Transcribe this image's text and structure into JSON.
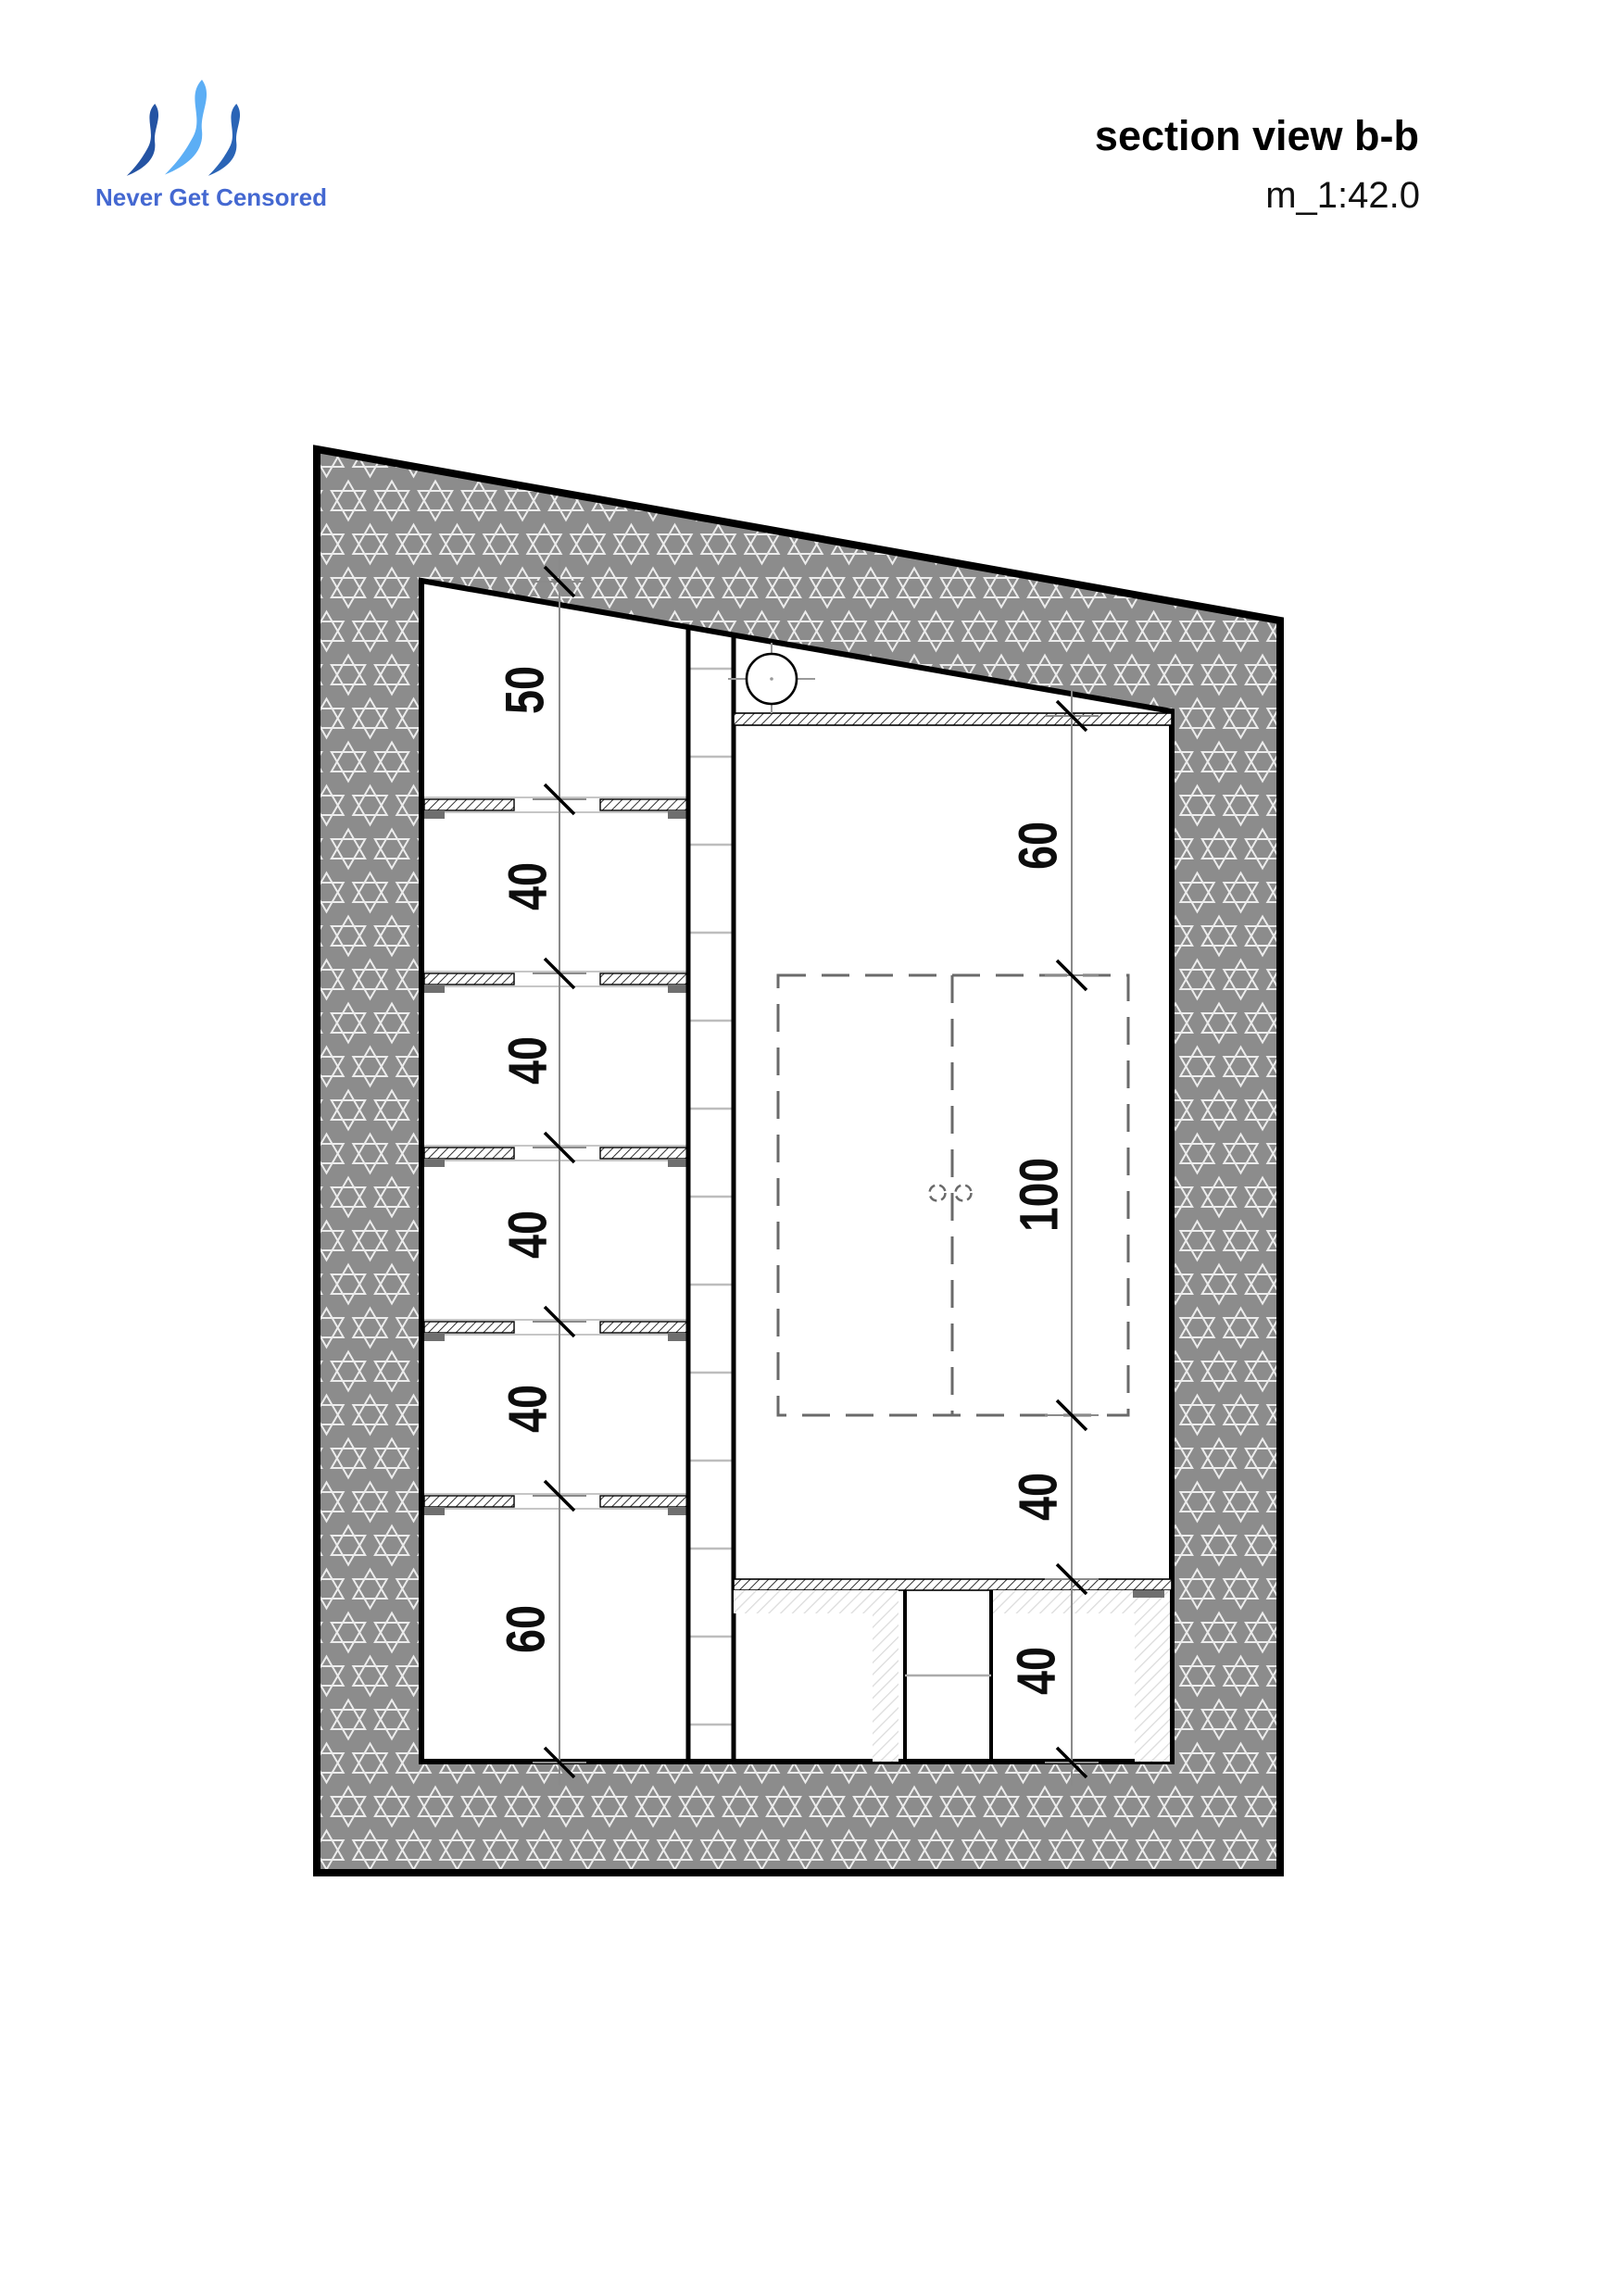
{
  "header": {
    "tagline": "Never Get Censored",
    "tagline_color": "#4468d1",
    "title": "section view b-b",
    "scale": "m_1:42.0",
    "logo_colors": {
      "left": "#2453a3",
      "middle": "#5caef5",
      "right": "#2a64b6"
    }
  },
  "drawing": {
    "type": "architectural-section",
    "view_name": "b-b",
    "scale_ratio": "1:42.0",
    "wall_fill": "#8c8c8c",
    "star_outline": "#ececec",
    "left_dimensions": [
      "50",
      "40",
      "40",
      "40",
      "40",
      "60"
    ],
    "right_dimensions": [
      "60",
      "100",
      "40",
      "40"
    ]
  }
}
